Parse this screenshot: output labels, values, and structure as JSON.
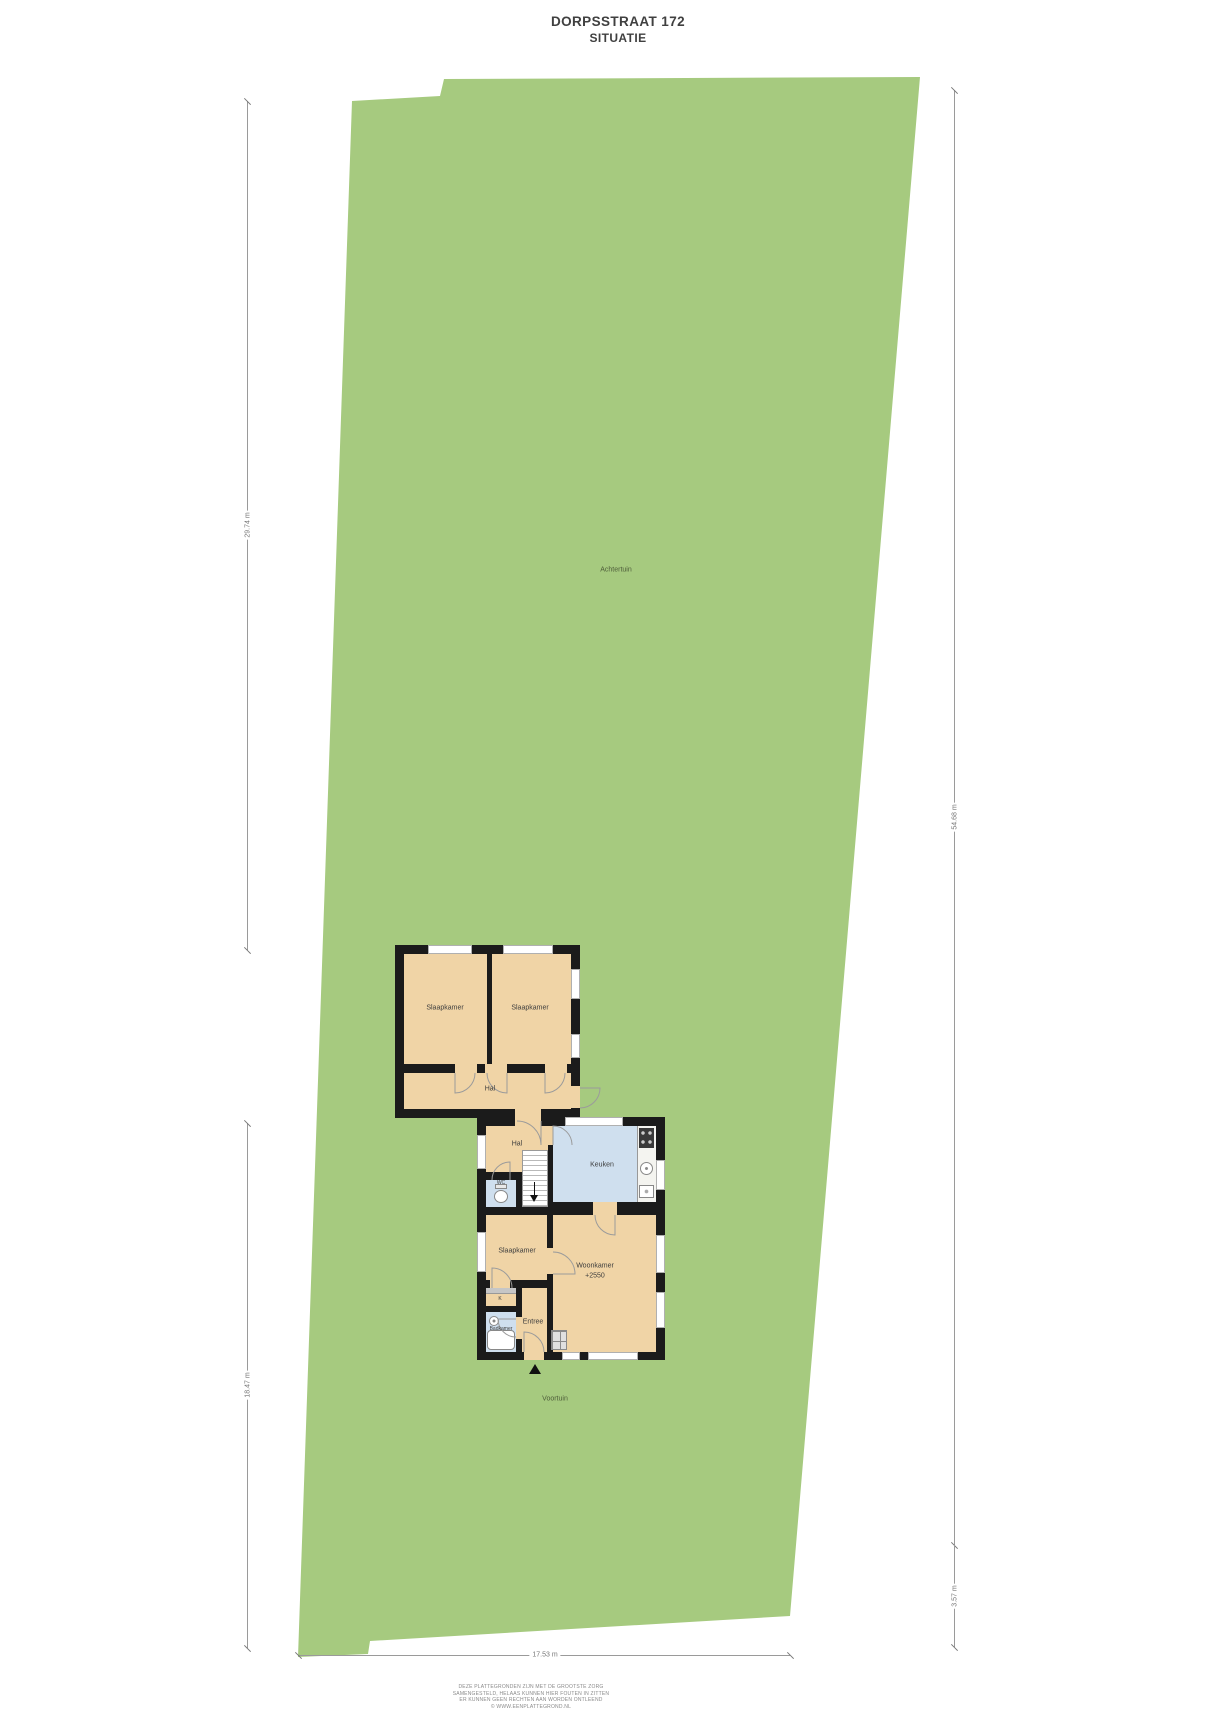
{
  "title": {
    "address": "DORPSSTRAAT 172",
    "subtitle": "SITUATIE"
  },
  "garden": {
    "back": "Achtertuin",
    "front": "Voortuin"
  },
  "rooms": {
    "bedroom_up_left": "Slaapkamer",
    "bedroom_up_right": "Slaapkamer",
    "hall_upper": "Hal",
    "hall_lower": "Hal",
    "wc": "WC",
    "kitchen": "Keuken",
    "bedroom_lower": "Slaapkamer",
    "living": "Woonkamer",
    "living_level": "+2550",
    "closet": "K",
    "bathroom": "Badkamer",
    "entry": "Entree"
  },
  "dimensions": {
    "left_top": "29.74 m",
    "left_bottom": "18.47 m",
    "right_top": "54.68 m",
    "right_bottom": "3.57 m",
    "bottom_width": "17.53 m"
  },
  "footer": {
    "line1": "DEZE PLATTEGRONDEN ZIJN MET DE GROOTSTE ZORG",
    "line2": "SAMENGESTELD, HELAAS KUNNEN HIER FOUTEN IN ZITTEN",
    "line3": "ER KUNNEN GEEN RECHTEN AAN WORDEN ONTLEEND",
    "line4": "© WWW.EENPLATTEGROND.NL"
  },
  "icons": {
    "entrance_marker": "triangle-up",
    "stairs_direction": "arrow-down"
  },
  "colors": {
    "plot_green": "#a6ca7f",
    "room_tan": "#f0d4a6",
    "room_blue": "#cfdfee",
    "wall": "#1b1b1b",
    "counter": "#f4f4f0",
    "dim_line": "#9a9a9a"
  }
}
